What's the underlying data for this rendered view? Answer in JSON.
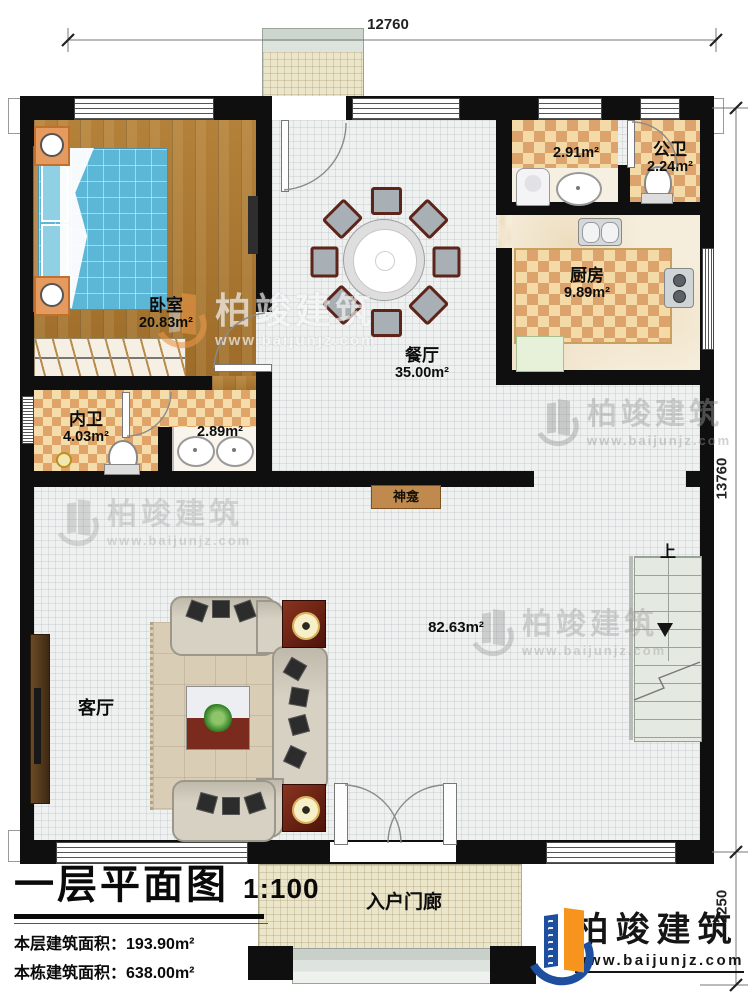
{
  "plan": {
    "title": "一层平面图",
    "scale": "1:100",
    "stats": [
      {
        "label": "本层建筑面积：",
        "value": "193.90m²"
      },
      {
        "label": "本栋建筑面积：",
        "value": "638.00m²"
      },
      {
        "label": "占地面积：",
        "value": "193.9m²"
      },
      {
        "label": "层高：",
        "value": "4.0m"
      }
    ]
  },
  "dimensions": {
    "top": "12760",
    "right_main": "13760",
    "right_porch": "2250"
  },
  "rooms": {
    "bedroom": {
      "name": "卧室",
      "area": "20.83m²"
    },
    "ensuite": {
      "name": "内卫",
      "area": "4.03m²"
    },
    "vanity": {
      "area": "2.89m²"
    },
    "dining": {
      "name": "餐厅",
      "area": "35.00m²"
    },
    "laundry": {
      "area": "2.91m²"
    },
    "public_bath": {
      "name": "公卫",
      "area": "2.24m²"
    },
    "kitchen": {
      "name": "厨房",
      "area": "9.89m²"
    },
    "living": {
      "name": "客厅",
      "area": "82.63m²"
    },
    "shrine": {
      "name": "神龛"
    },
    "porch": {
      "name": "入户门廊"
    },
    "stairs_up": "上"
  },
  "brand": {
    "name": "柏竣建筑",
    "url": "www.baijunjz.com"
  },
  "watermark": {
    "name": "柏竣建筑",
    "url": "www.baijunjz.com"
  },
  "colors": {
    "brand_blue": "#1d4f9e",
    "brand_orange": "#f7941d",
    "tile": "#dca36c",
    "wood": "#a9762e"
  }
}
